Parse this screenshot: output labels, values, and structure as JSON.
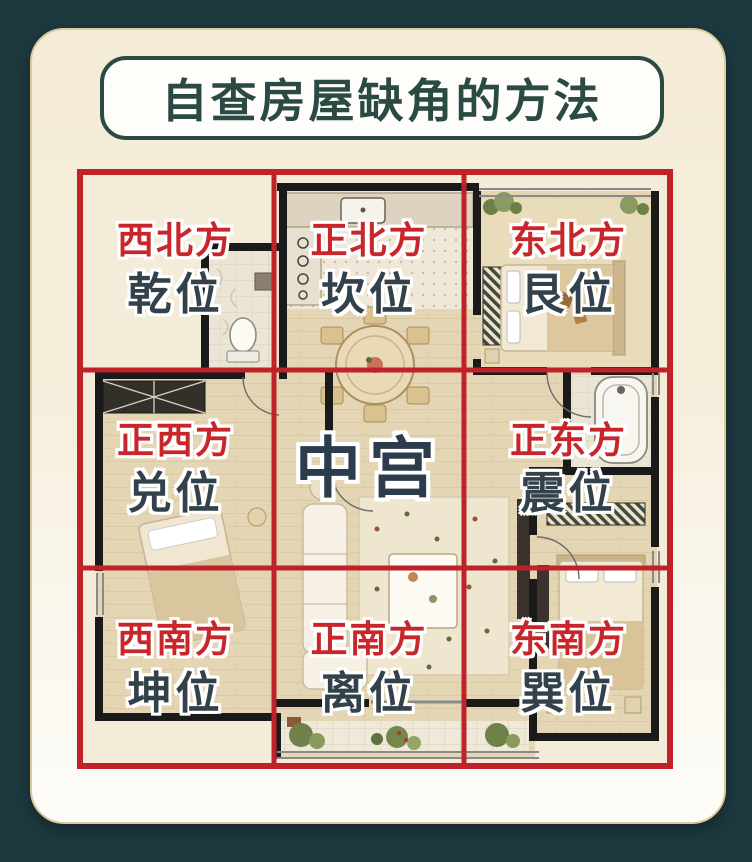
{
  "page": {
    "background_color": "#1d3a40",
    "card_color": "#f5eedb"
  },
  "title": {
    "text": "自查房屋缺角的方法",
    "color": "#2b4a43"
  },
  "compass_grid": {
    "grid_color": "#bf2329",
    "direction_color": "#c8262b",
    "position_color": "#33424a",
    "center_color": "#2d3c4d",
    "cells": [
      {
        "direction": "西北方",
        "position": "乾位"
      },
      {
        "direction": "正北方",
        "position": "坎位"
      },
      {
        "direction": "东北方",
        "position": "艮位"
      },
      {
        "direction": "正西方",
        "position": "兑位"
      },
      {
        "direction": "",
        "position": "中宫"
      },
      {
        "direction": "正东方",
        "position": "震位"
      },
      {
        "direction": "西南方",
        "position": "坤位"
      },
      {
        "direction": "正南方",
        "position": "离位"
      },
      {
        "direction": "东南方",
        "position": "巽位"
      }
    ]
  },
  "floorplan": {
    "rooms": [
      "kitchen",
      "dining-area",
      "northwest-bathroom",
      "northeast-bedroom",
      "west-bedroom",
      "living-room",
      "east-bathroom",
      "southeast-bedroom",
      "balcony"
    ]
  }
}
